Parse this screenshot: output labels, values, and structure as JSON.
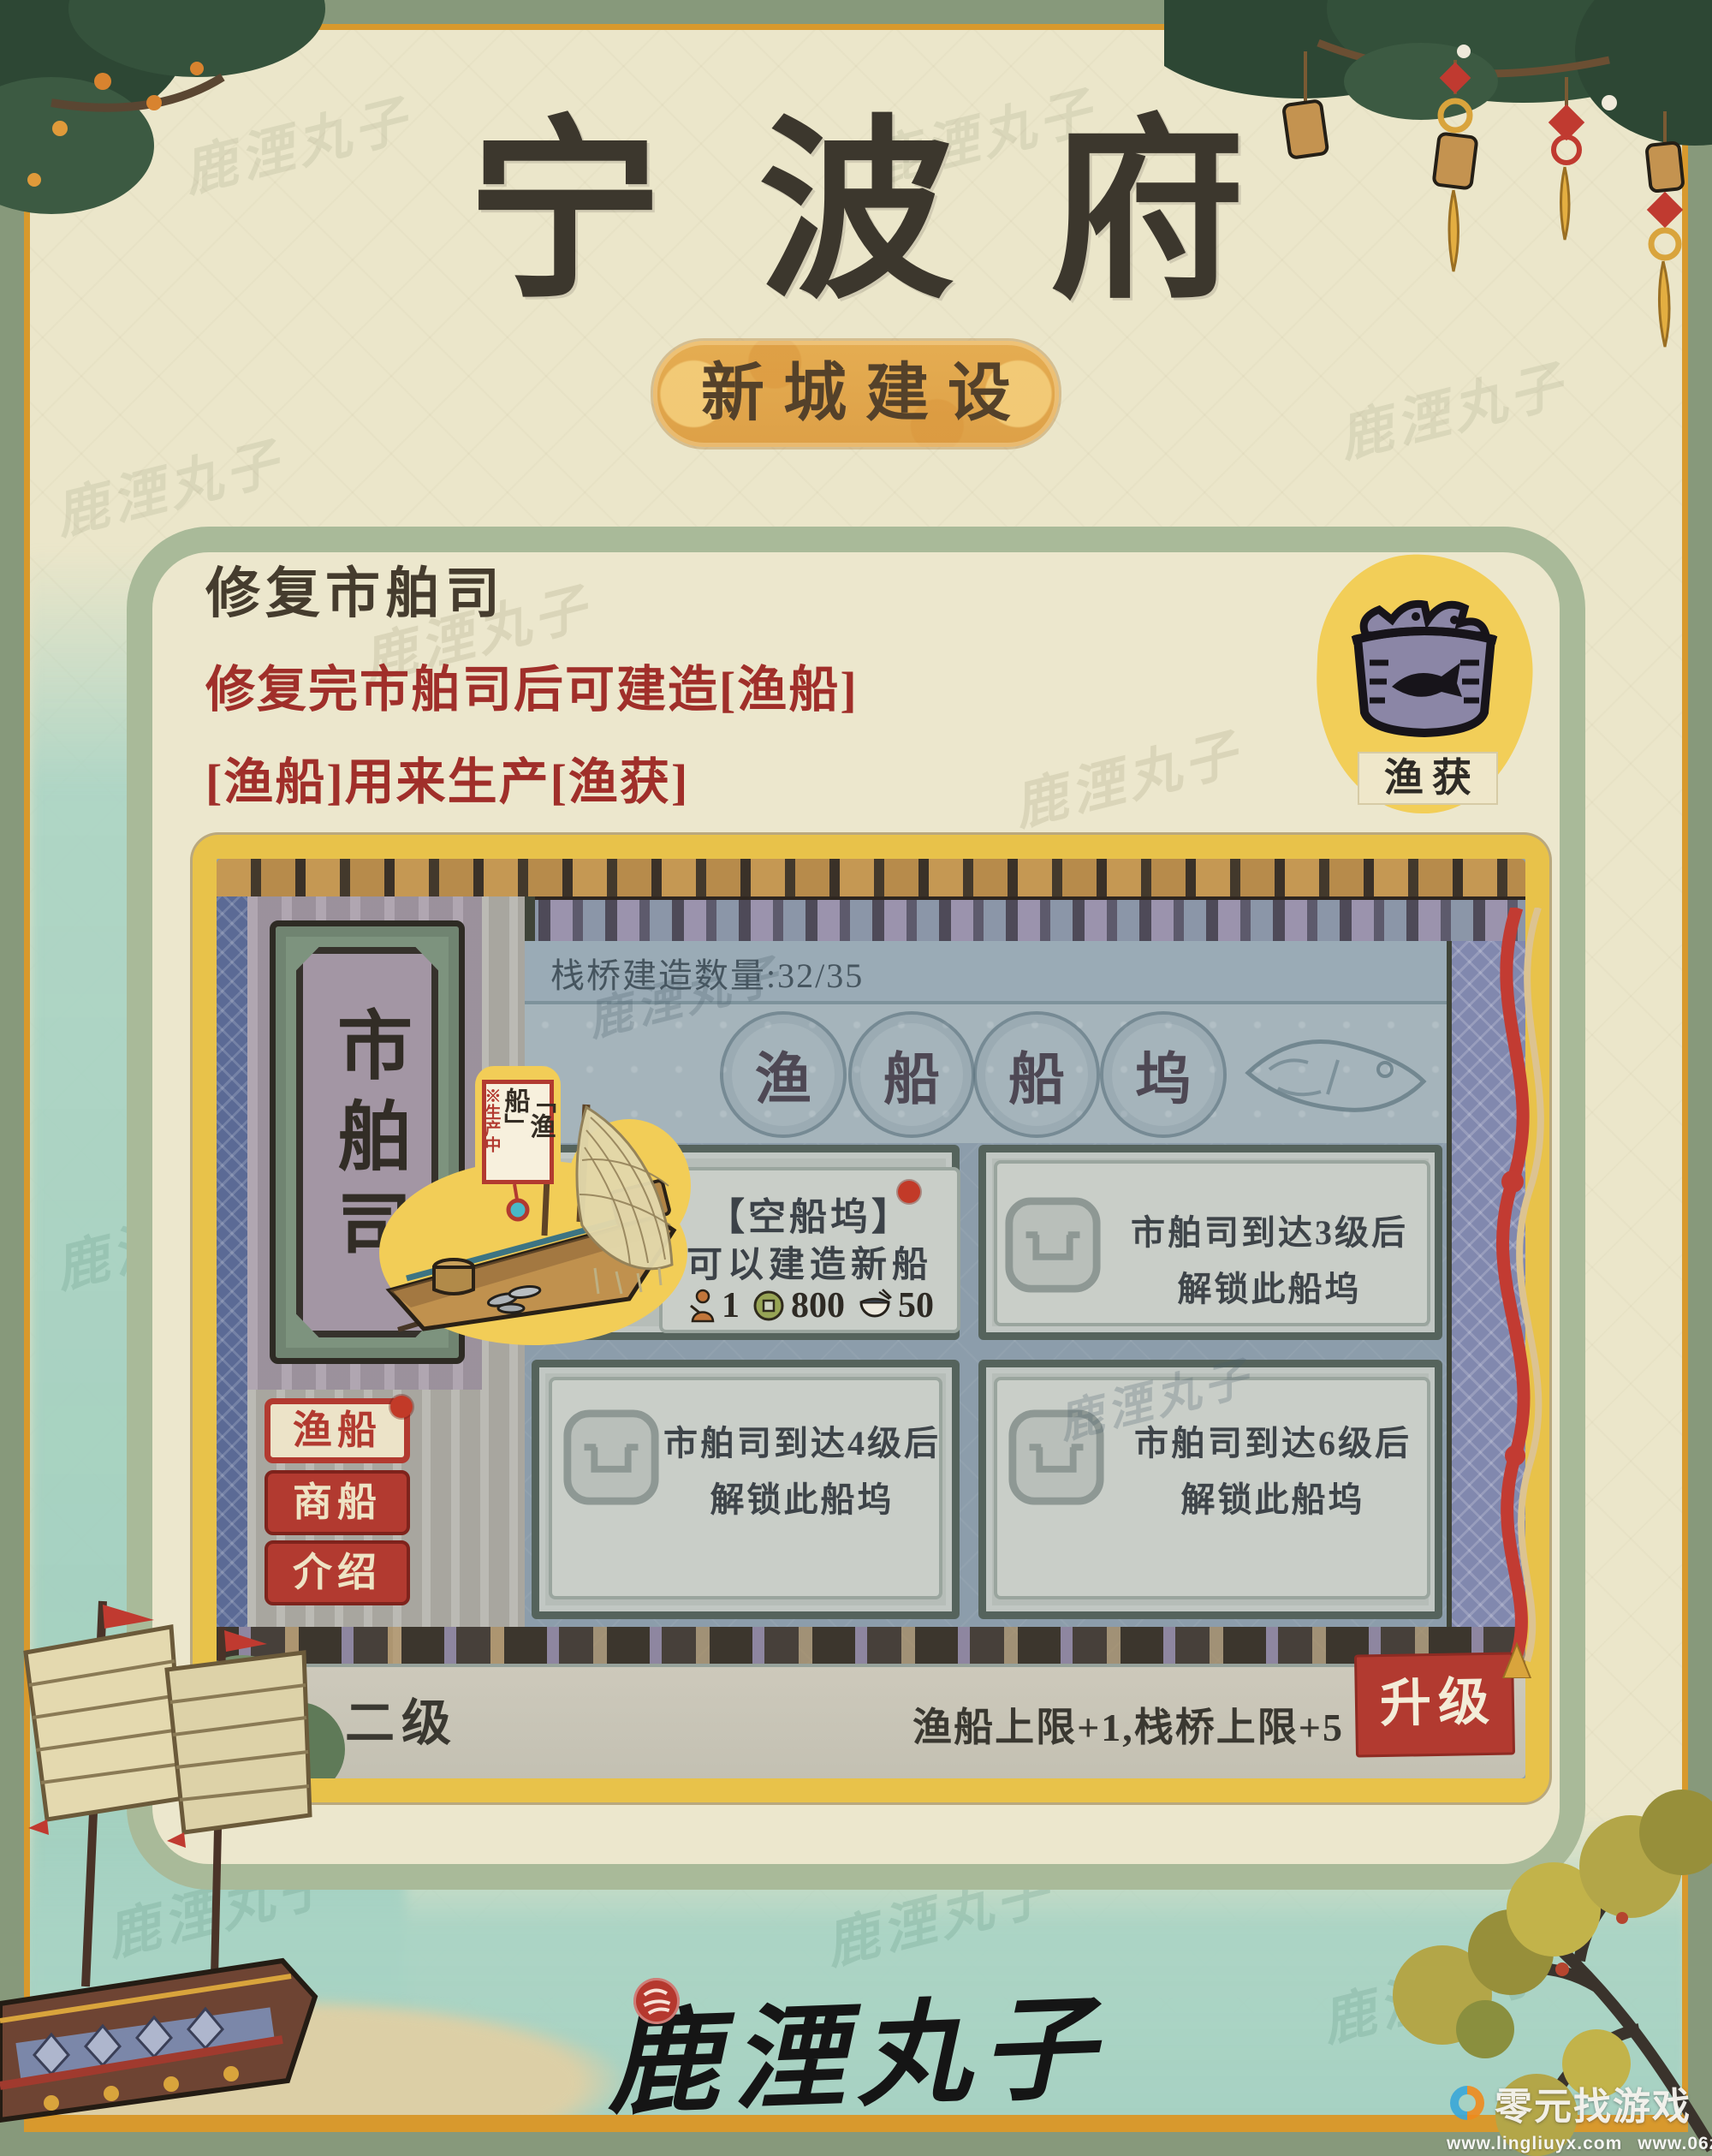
{
  "page": {
    "title": "宁波府",
    "badge": "新城建设",
    "section": {
      "heading": "修复市舶司",
      "line1": "修复完市舶司后可建造[渔船]",
      "line2": "[渔船]用来生产[渔获]"
    },
    "reward": {
      "label": "渔获"
    },
    "signature": "鹿湮丸子",
    "site_watermark": {
      "brand": "零元找游戏",
      "url1": "www.lingliuyx.com",
      "url2": "www.06zyx.com"
    }
  },
  "game": {
    "plaque": "市舶司",
    "bridge_counter": "栈桥建造数量:32/35",
    "dock_title": [
      "渔",
      "船",
      "船",
      "坞"
    ],
    "boat": {
      "name": "「渔船」",
      "status": "※生产中"
    },
    "empty_dock": {
      "title": "【空船坞】",
      "desc": "可以建造新船",
      "cost_worker": "1",
      "cost_coin": "800",
      "cost_food": "50"
    },
    "locked": [
      {
        "l1": "市舶司到达3级后",
        "l2": "解锁此船坞"
      },
      {
        "l1": "市舶司到达4级后",
        "l2": "解锁此船坞"
      },
      {
        "l1": "市舶司到达6级后",
        "l2": "解锁此船坞"
      }
    ],
    "tabs": [
      "渔船",
      "商船",
      "介绍"
    ],
    "footer": {
      "level": "二级",
      "perks": "渔船上限+1,栈桥上限+5",
      "upgrade": "升级"
    }
  }
}
